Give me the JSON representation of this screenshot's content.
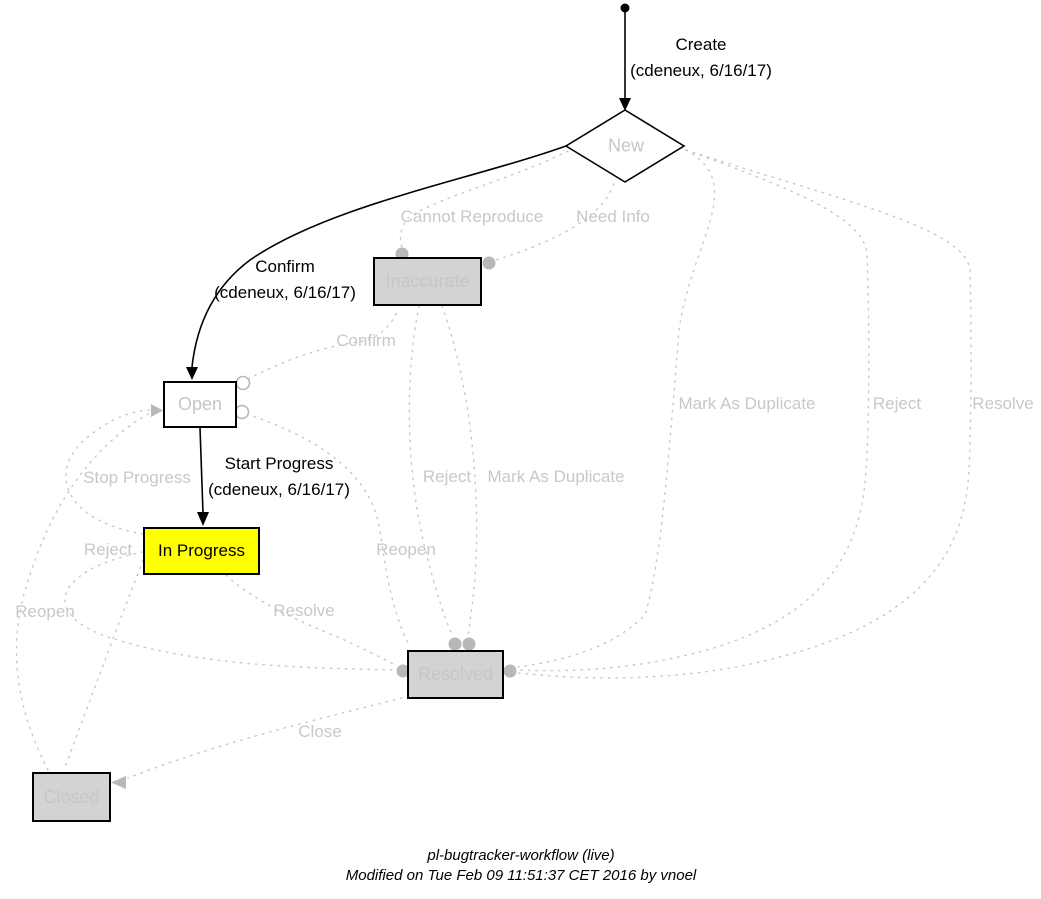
{
  "footer": {
    "title": "pl-bugtracker-workflow (live)",
    "modified": "Modified on Tue Feb 09 11:51:37 CET 2016 by vnoel"
  },
  "states": {
    "new": {
      "label": "New"
    },
    "open": {
      "label": "Open"
    },
    "in_progress": {
      "label": "In Progress"
    },
    "inaccurate": {
      "label": "Inaccurate"
    },
    "resolved": {
      "label": "Resolved"
    },
    "closed": {
      "label": "Closed"
    }
  },
  "transitions": {
    "create": {
      "label": "Create",
      "by": "(cdeneux, 6/16/17)"
    },
    "confirm": {
      "label": "Confirm",
      "by": "(cdeneux, 6/16/17)"
    },
    "start_progress": {
      "label": "Start Progress",
      "by": "(cdeneux, 6/16/17)"
    },
    "cannot_reproduce": {
      "label": "Cannot Reproduce"
    },
    "need_info": {
      "label": "Need Info"
    },
    "confirm_gray": {
      "label": "Confirm"
    },
    "mark_as_duplicate_right": {
      "label": "Mark As Duplicate"
    },
    "reject_right": {
      "label": "Reject"
    },
    "resolve_right": {
      "label": "Resolve"
    },
    "stop_progress": {
      "label": "Stop Progress"
    },
    "reject_mid": {
      "label": "Reject"
    },
    "mark_as_duplicate_mid": {
      "label": "Mark As Duplicate"
    },
    "reject_left": {
      "label": "Reject"
    },
    "reopen_mid": {
      "label": "Reopen"
    },
    "reopen_left": {
      "label": "Reopen"
    },
    "resolve_mid": {
      "label": "Resolve"
    },
    "close": {
      "label": "Close"
    }
  },
  "colors": {
    "active_edge": "#000000",
    "inactive_edge": "#c8c8c8",
    "state_fill": "#d3d3d3",
    "current_state_fill": "#ffff00",
    "endpoint_marker": "#b8b8b8"
  }
}
